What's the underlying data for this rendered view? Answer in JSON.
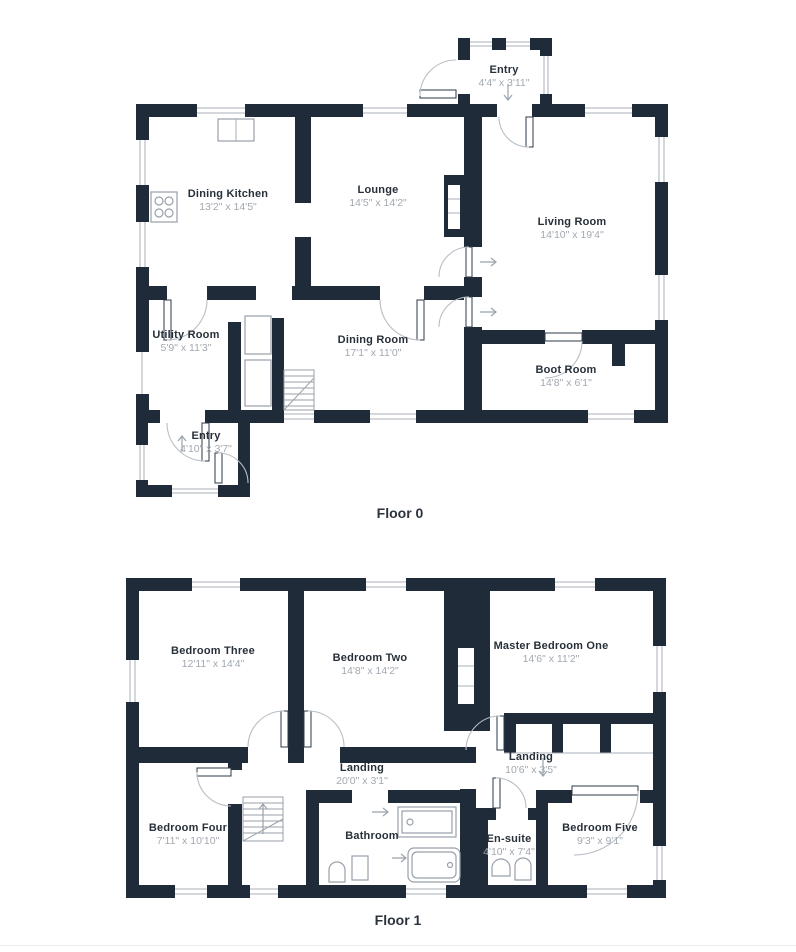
{
  "colors": {
    "wall": "#1f2b39",
    "room_name_text": "#273039",
    "dims_text": "#a2a9b1",
    "detail_line": "#a8afb7"
  },
  "floors": [
    {
      "caption": "Floor 0",
      "rooms": [
        {
          "name": "Entry",
          "dims": "4'4\" x 3'11\""
        },
        {
          "name": "Dining Kitchen",
          "dims": "13'2\" x 14'5\""
        },
        {
          "name": "Lounge",
          "dims": "14'5\" x 14'2\""
        },
        {
          "name": "Living Room",
          "dims": "14'10\" x 19'4\""
        },
        {
          "name": "Utility Room",
          "dims": "5'9\" x 11'3\""
        },
        {
          "name": "Dining Room",
          "dims": "17'1\" x 11'0\""
        },
        {
          "name": "Boot Room",
          "dims": "14'8\" x 6'1\""
        },
        {
          "name": "Entry",
          "dims": "4'10\" x 3'7\""
        }
      ]
    },
    {
      "caption": "Floor 1",
      "rooms": [
        {
          "name": "Bedroom Three",
          "dims": "12'11\" x 14'4\""
        },
        {
          "name": "Bedroom Two",
          "dims": "14'8\" x 14'2\""
        },
        {
          "name": "Master Bedroom One",
          "dims": "14'6\" x 11'2\""
        },
        {
          "name": "Landing",
          "dims": "20'0\" x 3'1\""
        },
        {
          "name": "Landing",
          "dims": "10'6\" x 3'5\""
        },
        {
          "name": "Bedroom Four",
          "dims": "7'11\" x 10'10\""
        },
        {
          "name": "Bathroom",
          "dims": ""
        },
        {
          "name": "En-suite",
          "dims": "4'10\" x 7'4\""
        },
        {
          "name": "Bedroom Five",
          "dims": "9'3\" x 9'1\""
        }
      ]
    }
  ]
}
